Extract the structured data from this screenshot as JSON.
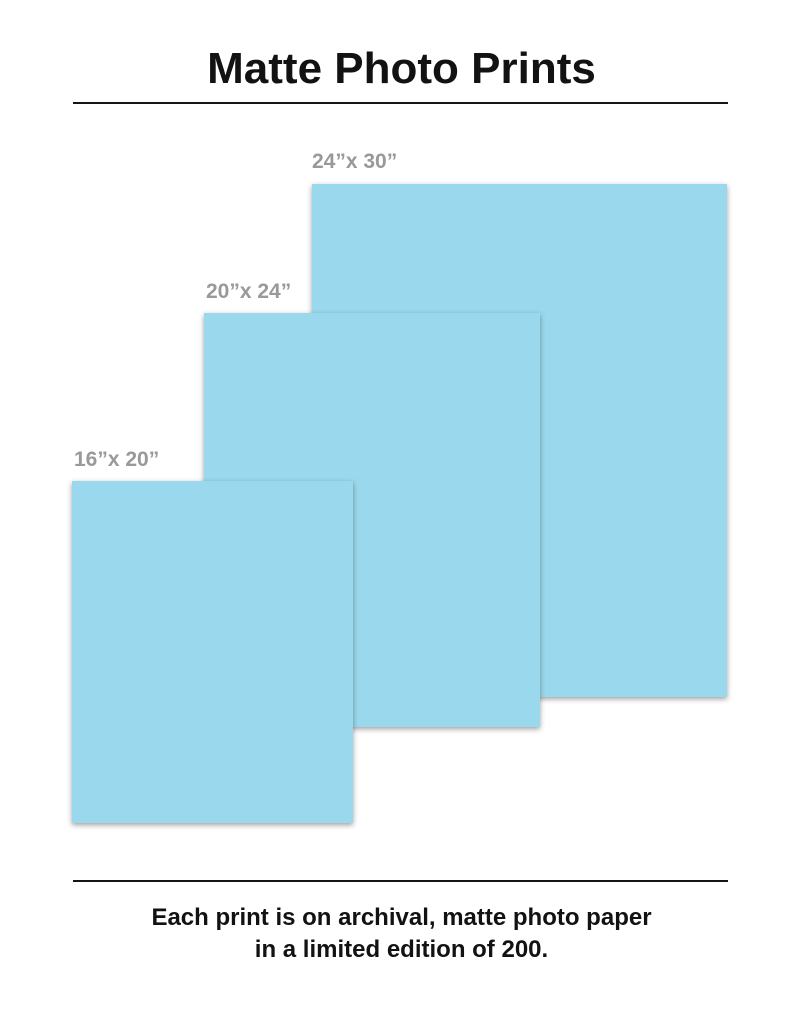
{
  "page": {
    "title": "Matte Photo Prints",
    "caption_line1": "Each print is on archival, matte photo paper",
    "caption_line2": "in a limited edition of 200."
  },
  "prints": [
    {
      "label": "24”x 30”",
      "size": "24x30"
    },
    {
      "label": "20”x 24”",
      "size": "20x24"
    },
    {
      "label": "16”x 20”",
      "size": "16x20"
    }
  ],
  "colors": {
    "print_fill": "#9ad9ed",
    "label_gray": "#97999b",
    "text_black": "#121212"
  }
}
